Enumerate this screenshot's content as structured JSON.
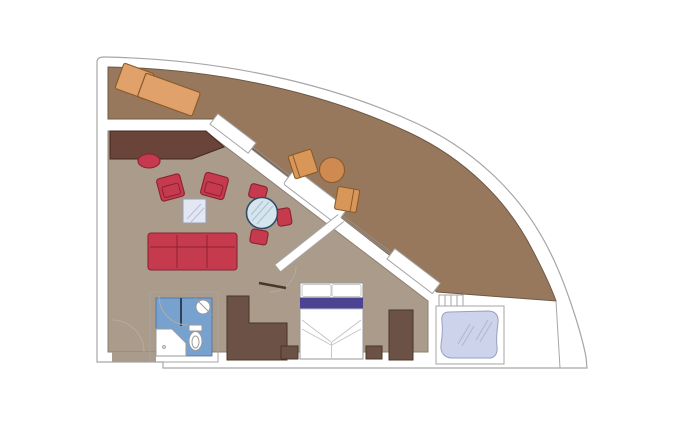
{
  "scene": {
    "type": "floor-plan",
    "subject": "cruise-ship-suite-with-wraparound-terrace",
    "width": 700,
    "height": 433
  },
  "colors": {
    "background": "#ffffff",
    "hull_fill": "#ffffff",
    "wall_outline": "#a6a6a6",
    "terrace_floor": "#97785c",
    "terrace_outline": "#6d5a45",
    "interior_floor": "#aa9b8a",
    "red_upholstery": "#c53a4d",
    "red_outline": "#8c2133",
    "desk_wood": "#6a4339",
    "dark_wood": "#6b5146",
    "terrace_wood": "#d89659",
    "terrace_wood_light": "#e0a16a",
    "terrace_table_wood": "#cf8a52",
    "bathroom_floor": "#77a1cf",
    "glass_table": "#d6e4ee",
    "coffee_glass": "#e3e6f3",
    "whirlpool_water": "#ccd3ea",
    "bed_purple": "#4c4392",
    "fixture_white": "#ffffff",
    "door_arc": "#b5ab9e",
    "threshold_dark": "#4a372c"
  },
  "rooms": [
    {
      "id": "terrace"
    },
    {
      "id": "living-room"
    },
    {
      "id": "bedroom"
    },
    {
      "id": "bathroom"
    },
    {
      "id": "whirlpool-deck"
    }
  ],
  "furniture": {
    "terrace": [
      "sun-lounger",
      "round-table",
      "deck-chair",
      "deck-chair"
    ],
    "living_room": [
      "corner-desk",
      "desk-stool",
      "armchair",
      "armchair",
      "coffee-table",
      "dining-table",
      "dining-chair",
      "dining-chair",
      "dining-chair",
      "sofa"
    ],
    "bedroom": [
      "double-bed",
      "pillow",
      "pillow",
      "nightstand",
      "nightstand",
      "wardrobe"
    ],
    "bathroom": [
      "shower",
      "toilet",
      "washbasin"
    ],
    "whirlpool_deck": [
      "whirlpool-tub",
      "steps"
    ]
  }
}
